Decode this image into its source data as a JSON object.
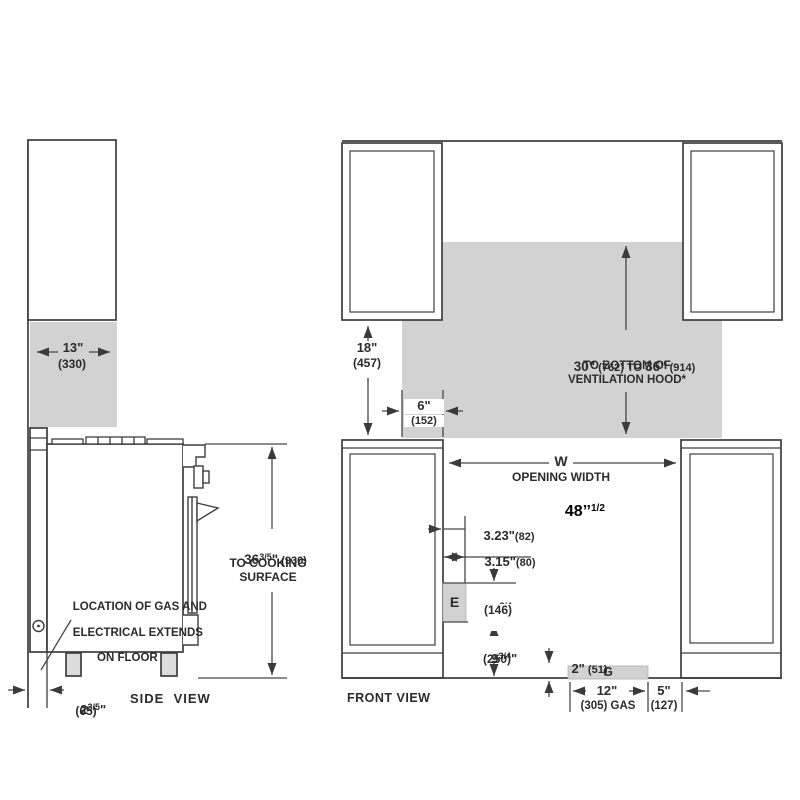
{
  "colors": {
    "line": "#3e3e3e",
    "dim_line": "#474747",
    "fill_gray": "#d2d2d2",
    "text": "#2b2b2b",
    "annotation": "#000000"
  },
  "side_view": {
    "view_label": "SIDE  VIEW",
    "depth_dim": {
      "in": "13\"",
      "mm": "(330)"
    },
    "height_dim": {
      "num": "36",
      "frac": "3/5",
      "unit": "\"",
      "mm": " (930)",
      "line2": "TO COOKING",
      "line3": "SURFACE"
    },
    "gas_note": {
      "line1": "LOCATION OF GAS AND",
      "line2": "ELECTRICAL EXTENDS",
      "line3": "ON FLOOR"
    },
    "wall_gap_dim": {
      "num": "2",
      "frac": "3/5",
      "unit": "\"",
      "mm": "(65)"
    }
  },
  "front_view": {
    "view_label": "FRONT VIEW",
    "upper_cabinet_dim": {
      "in": "18\"",
      "mm": "(457)"
    },
    "hood_side_dim": {
      "in": "6\"",
      "mm": "(152)"
    },
    "hood_height_dim": {
      "v1": "30\"",
      "mid": " (762) TO ",
      "v2": "36\"",
      "end": " (914)",
      "line2": "TO BOTTOM OF",
      "line3": "VENTILATION HOOD*"
    },
    "opening": {
      "symbol": "W",
      "label": "OPENING WIDTH",
      "value": "48’’",
      "value_frac": "1/2"
    },
    "electrical": {
      "block_label": "E",
      "offset_in": "3.23\"",
      "offset_mm": "(82)",
      "width_in": "3.15\"",
      "width_mm": "(80)",
      "height_dim": {
        "num": "5",
        "frac": "3/4",
        "unit": "\"",
        "mm": "(146)"
      },
      "floor_dim": {
        "num": "9",
        "frac": "3/4",
        "unit": "\"",
        "mm": "(250)"
      }
    },
    "gas": {
      "block_label": "G",
      "height_in": "2\"",
      "height_mm": " (51)",
      "width_in": "12\"",
      "width_mm": "(305) GAS",
      "right_in": "5\"",
      "right_mm": "(127)"
    }
  }
}
